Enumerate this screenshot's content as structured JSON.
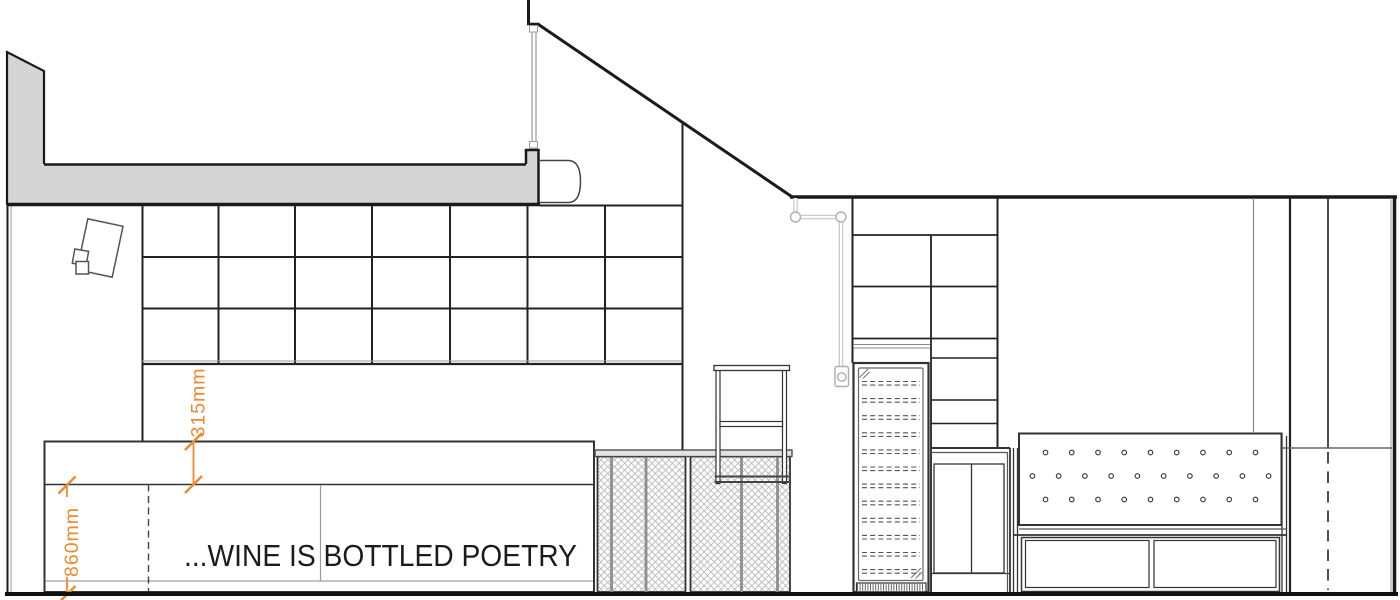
{
  "drawing": {
    "type_label": "interior-elevation",
    "quote": "...WINE IS BOTTLED POETRY",
    "dimensions": {
      "ledge_height": "315mm",
      "counter_height": "860mm"
    },
    "colors": {
      "dimension_orange": "#EC8A31",
      "line_dark": "#222222",
      "beam_gray": "#d5d5d5",
      "pipe_gray": "#c4c4c4",
      "mesh_gray": "#b5b5b5"
    }
  },
  "scene": {
    "mesh": {
      "spacing": 6.8,
      "color": "#b5b5b5",
      "panels": [
        {
          "x": 597.5,
          "y": 456.5,
          "w": 88.0,
          "h": 135.5
        },
        {
          "x": 690.5,
          "y": 456.5,
          "w": 99.5,
          "h": 135.5
        }
      ]
    },
    "tufting": {
      "radius": 2.3,
      "color": "#333333",
      "rows": [
        {
          "y": 452.5,
          "count": 9,
          "x0": 1045.5,
          "step": 26.25
        },
        {
          "y": 476.0,
          "count": 10,
          "x0": 1032.4,
          "step": 26.25
        },
        {
          "y": 499.5,
          "count": 9,
          "x0": 1045.5,
          "step": 26.25
        }
      ]
    },
    "wine_racks": {
      "x1": 862,
      "x2": 920,
      "y0": 381.5,
      "step": 17.1,
      "count": 12,
      "pair_gap": 3.6,
      "dash": "5,3.2",
      "color": "#555555"
    },
    "vent": {
      "x1": 857.5,
      "x2": 924.5,
      "y": 583.8,
      "h": 7,
      "step": 2.6,
      "color": "#666666"
    }
  }
}
